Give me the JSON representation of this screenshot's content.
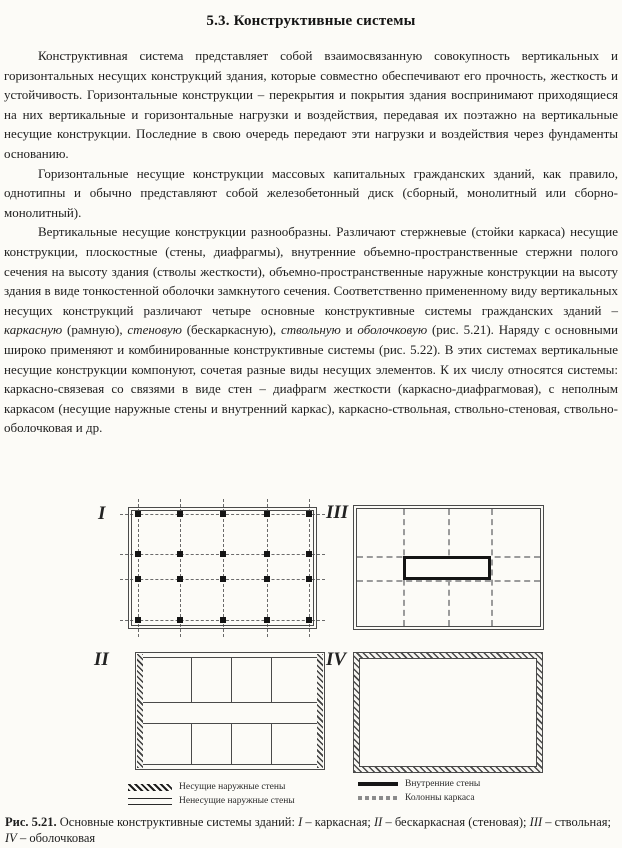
{
  "doc": {
    "title": "5.3. Конструктивные системы",
    "paragraphs": [
      {
        "segments": [
          {
            "t": "Конструктивная система представляет собой взаимосвязанную совокупность вертикальных и горизонтальных несущих конструкций здания, которые совместно обеспечивают его прочность, жесткость и устойчивость. Горизонтальные конструкции – перекрытия и покрытия здания воспринимают приходящиеся на них вертикальные и горизонтальные нагрузки и воздействия, передавая их поэтажно на вертикальные несущие конструкции. Последние в свою очередь передают эти нагрузки и воздействия через фундаменты основанию."
          }
        ]
      },
      {
        "segments": [
          {
            "t": "Горизонтальные несущие конструкции массовых капитальных гражданских зданий, как правило, однотипны и обычно представляют собой железобетонный диск (сборный, монолитный или сборно-монолитный)."
          }
        ]
      },
      {
        "segments": [
          {
            "t": "Вертикальные несущие конструкции разнообразны. Различают стержневые (стойки каркаса) несущие конструкции, плоскостные (стены, диафрагмы), внутренние объемно-пространственные стержни полого сечения на высоту здания (стволы жесткости), объемно-пространственные наружные конструкции на высоту здания в виде тонкостенной оболочки замкнутого сечения. Соответственно примененному виду вертикальных несущих конструкций различают четыре основные конструктивные системы гражданских зданий – "
          },
          {
            "t": "каркасную",
            "i": true
          },
          {
            "t": " (рамную), "
          },
          {
            "t": "стеновую",
            "i": true
          },
          {
            "t": " (бескаркасную), "
          },
          {
            "t": "ствольную",
            "i": true
          },
          {
            "t": " и "
          },
          {
            "t": "оболочковую",
            "i": true
          },
          {
            "t": " (рис. 5.21). Наряду с основными широко применяют и комбинированные конструктивные системы (рис. 5.22). В этих системах вертикальные несущие конструкции компонуют, сочетая разные виды несущих элементов. К их числу относятся системы: каркасно-связевая со связями в виде стен – диафрагм жесткости (каркасно-диафрагмовая), с неполным каркасом (несущие наружные стены и внутренний каркас), каркасно-ствольная, ствольно-стеновая, ствольно-оболочковая и др."
          }
        ]
      }
    ]
  },
  "figure": {
    "diagram_labels": {
      "frame": "I",
      "wall": "II",
      "core": "III",
      "shell": "IV"
    },
    "legend_left": [
      {
        "symbol": "hatch-band",
        "label": "Несущие наружные стены"
      },
      {
        "symbol": "double-line",
        "label": "Ненесущие наружные стены"
      }
    ],
    "legend_right": [
      {
        "symbol": "solid-thick-line",
        "label": "Внутренние стены"
      },
      {
        "symbol": "gray-dashed-line",
        "label": "Колонны каркаса"
      }
    ],
    "caption_segments": [
      {
        "t": "Рис. 5.21.",
        "b": true
      },
      {
        "t": " Основные конструктивные системы зданий: "
      },
      {
        "t": "I",
        "i": true
      },
      {
        "t": " – каркасная; "
      },
      {
        "t": "II",
        "i": true
      },
      {
        "t": " – бескаркасная (стеновая); "
      },
      {
        "t": "III",
        "i": true
      },
      {
        "t": " – ствольная; "
      },
      {
        "t": "IV",
        "i": true
      },
      {
        "t": " – оболочковая"
      }
    ],
    "colors": {
      "paper": "#fcfbf7",
      "ink": "#1c1c1c",
      "line": "#4a4a4a",
      "gray_axis": "#9b9b9b"
    }
  }
}
